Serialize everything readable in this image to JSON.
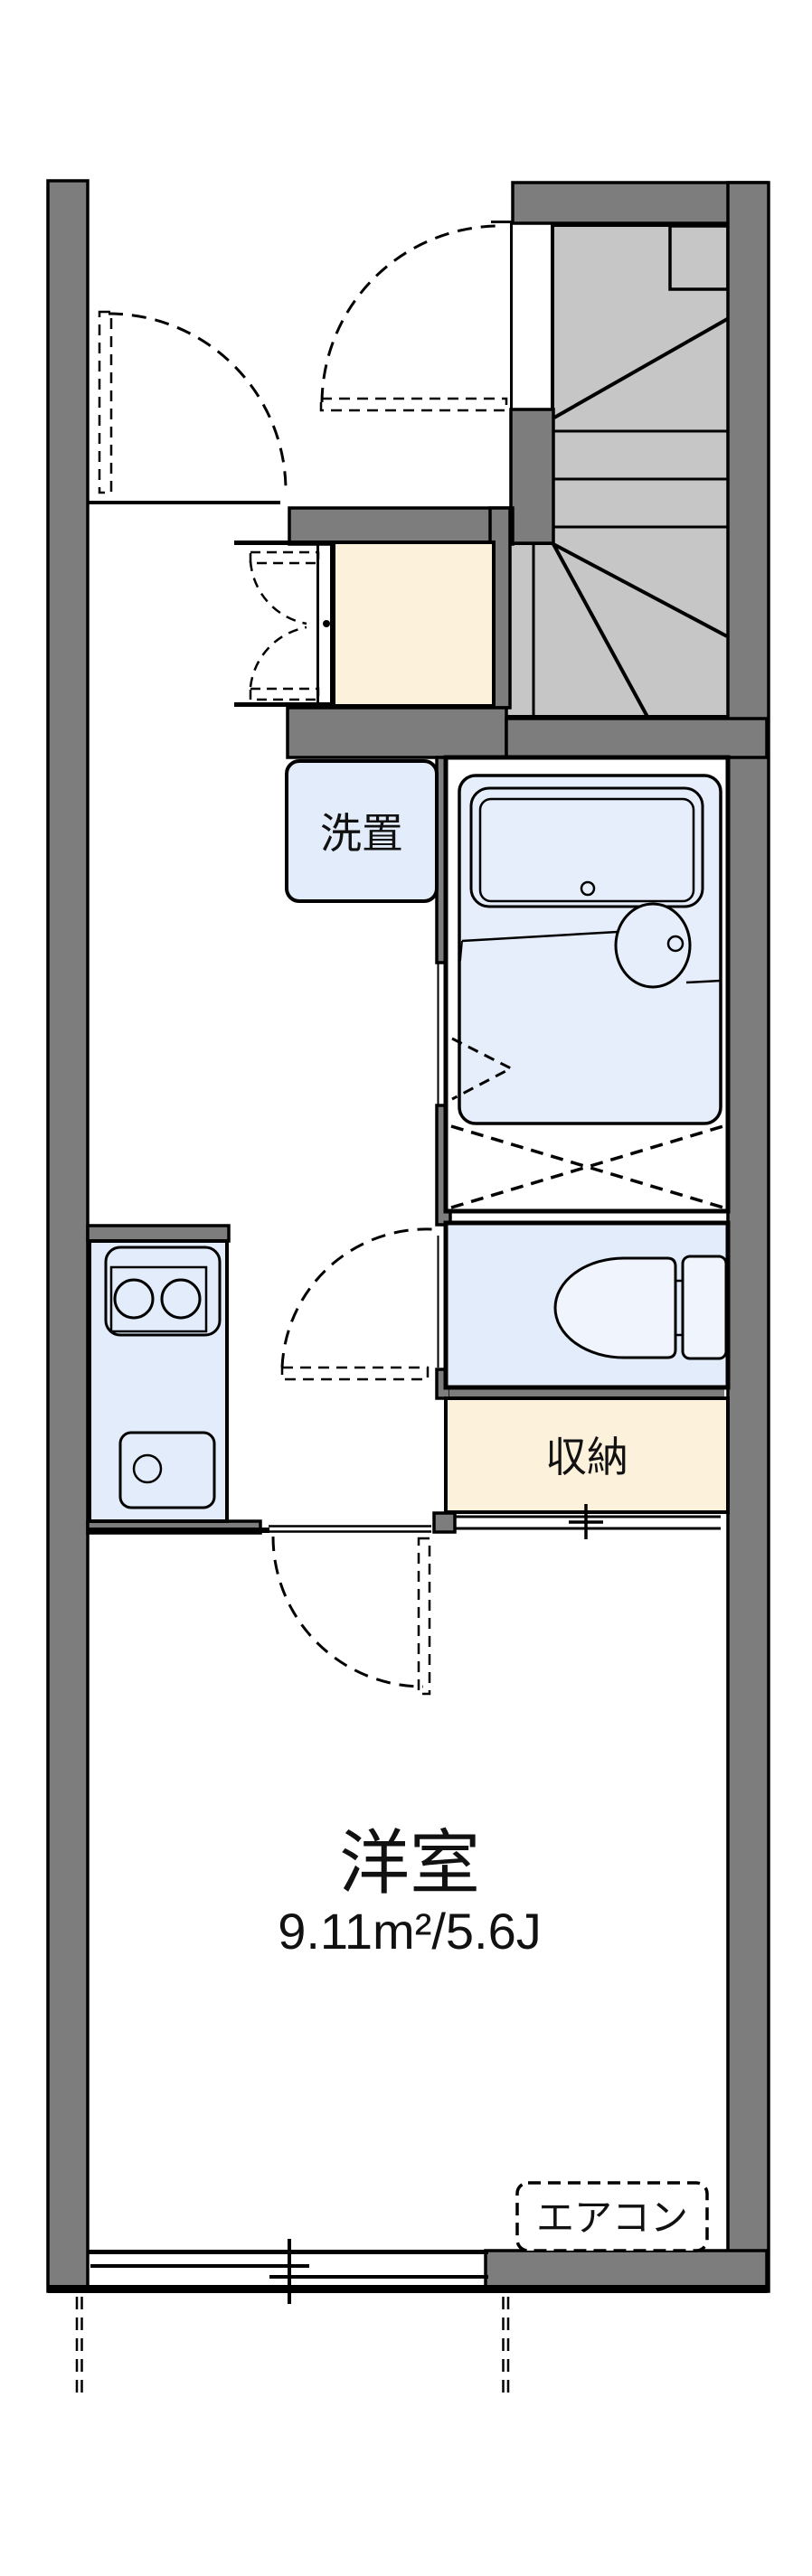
{
  "plan": {
    "type": "japanese-apartment-floor-plan",
    "labels": {
      "washer_space": "洗置",
      "storage": "収納",
      "western_room": "洋室",
      "western_room_area": "9.11m²/5.6J",
      "air_conditioner": "エアコン"
    },
    "rooms": [
      {
        "name": "washer_space",
        "text": "洗置"
      },
      {
        "name": "storage",
        "text": "収納"
      },
      {
        "name": "western_room",
        "text": "洋室",
        "area": "9.11m²/5.6J"
      },
      {
        "name": "air_conditioner",
        "text": "エアコン"
      }
    ],
    "colors": {
      "wall_gray": "#7d7d7d",
      "stair_gray": "#c6c6c6",
      "fixture_blue": "#e3ecfa",
      "bath_unit_blue": "#e6eefb",
      "porcelain_blue": "#f0f5fd",
      "floor_cream": "#fcf1da",
      "line_black": "#000000",
      "background_white": "#ffffff"
    }
  }
}
